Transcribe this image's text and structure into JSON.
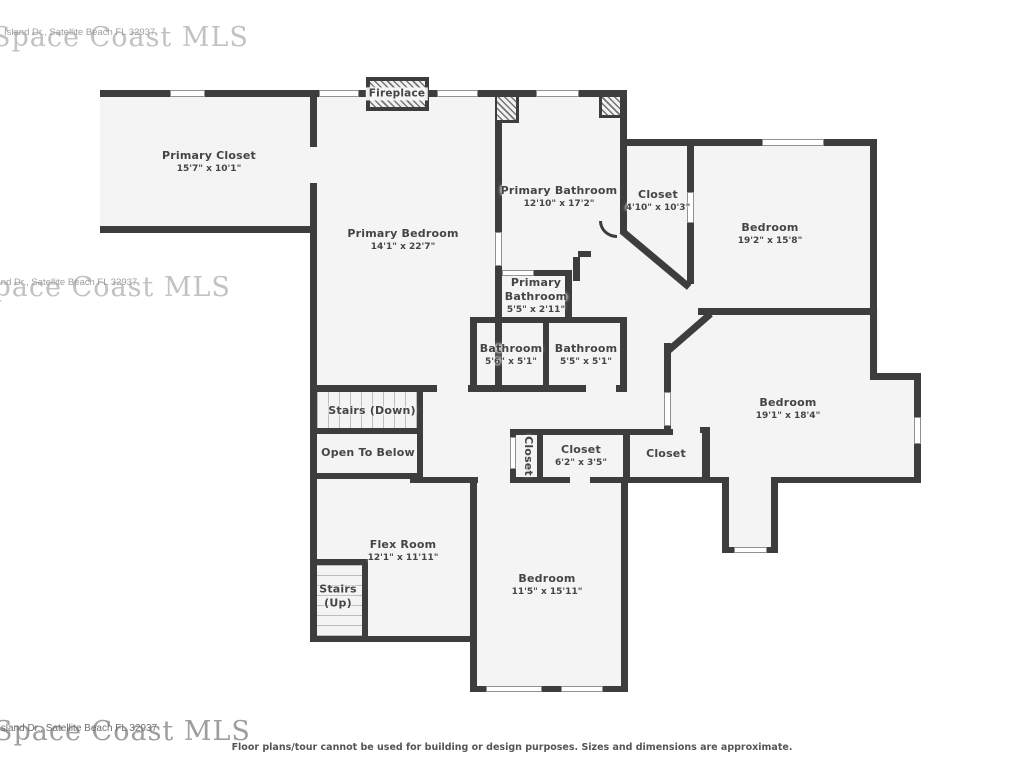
{
  "disclaimer": "Floor plans/tour cannot be used for building or design purposes. Sizes and dimensions are approximate.",
  "watermarks": [
    {
      "big": "Space Coast MLS",
      "small": "Island Dr., Satellite Beach FL 32937"
    },
    {
      "big": "Space Coast MLS",
      "small": "Island Dr., Satellite Beach FL 32937"
    },
    {
      "big": "Space Coast MLS",
      "small": "Island Dr., Satellite Beach FL 32937"
    }
  ],
  "colors": {
    "wall": "#3d3d3d",
    "floor": "#f4f4f4",
    "window_line": "#919191",
    "label": "#454545",
    "watermark": "#c2c2c2"
  },
  "rooms": [
    {
      "id": "primary-closet",
      "name": "Primary Closet",
      "dims": "15'7\" x 10'1\"",
      "cx": 209,
      "cy": 162
    },
    {
      "id": "primary-bedroom",
      "name": "Primary Bedroom",
      "dims": "14'1\" x 22'7\"",
      "cx": 403,
      "cy": 240
    },
    {
      "id": "primary-bathroom",
      "name": "Primary Bathroom",
      "dims": "12'10\" x 17'2\"",
      "cx": 559,
      "cy": 197
    },
    {
      "id": "closet-top",
      "name": "Closet",
      "dims": "4'10\" x 10'3\"",
      "cx": 658,
      "cy": 201
    },
    {
      "id": "bedroom-top-right",
      "name": "Bedroom",
      "dims": "19'2\" x 15'8\"",
      "cx": 770,
      "cy": 234
    },
    {
      "id": "primary-bathroom-small",
      "name": "Primary Bathroom",
      "dims": "5'5\" x 2'11\"",
      "cx": 536,
      "cy": 296,
      "w": 66
    },
    {
      "id": "bathroom-left",
      "name": "Bathroom",
      "dims": "5'6\" x 5'1\"",
      "cx": 511,
      "cy": 355
    },
    {
      "id": "bathroom-right",
      "name": "Bathroom",
      "dims": "5'5\" x 5'1\"",
      "cx": 586,
      "cy": 355
    },
    {
      "id": "bedroom-middle",
      "name": "Bedroom",
      "dims": "19'1\" x 18'4\"",
      "cx": 788,
      "cy": 409
    },
    {
      "id": "stairs-down",
      "name": "Stairs (Down)",
      "dims": "",
      "cx": 372,
      "cy": 411
    },
    {
      "id": "open-to-below",
      "name": "Open To Below",
      "dims": "",
      "cx": 368,
      "cy": 453
    },
    {
      "id": "closet-narrow",
      "name": "Closet",
      "dims": "",
      "cx": 528,
      "cy": 456,
      "rot": 90
    },
    {
      "id": "closet-62",
      "name": "Closet",
      "dims": "6'2\" x 3'5\"",
      "cx": 581,
      "cy": 456
    },
    {
      "id": "closet-right",
      "name": "Closet",
      "dims": "",
      "cx": 666,
      "cy": 454
    },
    {
      "id": "flex-room",
      "name": "Flex Room",
      "dims": "12'1\" x 11'11\"",
      "cx": 403,
      "cy": 551
    },
    {
      "id": "stairs-up",
      "name": "Stairs (Up)",
      "dims": "",
      "cx": 338,
      "cy": 596,
      "w": 46
    },
    {
      "id": "bedroom-bottom",
      "name": "Bedroom",
      "dims": "11'5\" x 15'11\"",
      "cx": 547,
      "cy": 585
    },
    {
      "id": "fireplace",
      "name": "Fireplace",
      "dims": "",
      "cx": 397,
      "cy": 94,
      "fp": true
    }
  ],
  "geometry": {
    "fills": [
      [
        100,
        90,
        217,
        143
      ],
      [
        310,
        90,
        192,
        302
      ],
      [
        495,
        90,
        132,
        227
      ],
      [
        470,
        317,
        157,
        75
      ],
      [
        620,
        139,
        74,
        150
      ],
      [
        690,
        139,
        187,
        176
      ],
      [
        627,
        227,
        73,
        206
      ],
      [
        417,
        385,
        254,
        98
      ],
      [
        671,
        308,
        207,
        175
      ],
      [
        878,
        373,
        43,
        110
      ],
      [
        722,
        483,
        56,
        70
      ],
      [
        510,
        429,
        200,
        54
      ],
      [
        313,
        385,
        110,
        94
      ],
      [
        313,
        479,
        157,
        163
      ],
      [
        470,
        477,
        158,
        215
      ]
    ],
    "stairs": [
      {
        "id": "down",
        "dir": "v",
        "r": [
          317,
          392,
          100,
          36
        ]
      },
      {
        "id": "up",
        "dir": "h",
        "r": [
          316,
          565,
          46,
          71
        ]
      }
    ],
    "walls": [
      [
        100,
        90,
        527,
        7
      ],
      [
        100,
        226,
        217,
        7
      ],
      [
        620,
        139,
        257,
        7
      ],
      [
        698,
        308,
        179,
        7
      ],
      [
        310,
        385,
        127,
        7
      ],
      [
        468,
        385,
        118,
        7
      ],
      [
        616,
        385,
        11,
        7
      ],
      [
        313,
        428,
        110,
        6
      ],
      [
        313,
        473,
        110,
        6
      ],
      [
        510,
        429,
        163,
        6
      ],
      [
        700,
        427,
        10,
        6
      ],
      [
        410,
        477,
        68,
        6
      ],
      [
        510,
        477,
        60,
        6
      ],
      [
        590,
        477,
        120,
        6
      ],
      [
        313,
        636,
        157,
        6
      ],
      [
        470,
        686,
        158,
        6
      ],
      [
        313,
        559,
        55,
        6
      ],
      [
        495,
        270,
        77,
        6
      ],
      [
        470,
        317,
        157,
        6
      ],
      [
        870,
        373,
        51,
        7
      ],
      [
        778,
        477,
        143,
        6
      ],
      [
        722,
        547,
        56,
        6
      ],
      [
        702,
        477,
        27,
        6
      ],
      [
        578,
        251,
        13,
        6
      ],
      [
        310,
        90,
        7,
        57
      ],
      [
        310,
        183,
        7,
        459
      ],
      [
        495,
        97,
        7,
        136
      ],
      [
        495,
        265,
        7,
        127
      ],
      [
        620,
        90,
        7,
        143
      ],
      [
        687,
        146,
        7,
        47
      ],
      [
        687,
        222,
        7,
        62
      ],
      [
        870,
        139,
        7,
        176
      ],
      [
        870,
        312,
        7,
        68
      ],
      [
        914,
        380,
        7,
        38
      ],
      [
        914,
        443,
        7,
        40
      ],
      [
        664,
        343,
        7,
        50
      ],
      [
        664,
        425,
        7,
        8
      ],
      [
        722,
        477,
        7,
        76
      ],
      [
        771,
        477,
        7,
        76
      ],
      [
        510,
        429,
        6,
        9
      ],
      [
        510,
        468,
        6,
        15
      ],
      [
        537,
        435,
        6,
        48
      ],
      [
        623,
        429,
        7,
        54
      ],
      [
        702,
        427,
        8,
        56
      ],
      [
        470,
        477,
        7,
        215
      ],
      [
        621,
        477,
        7,
        215
      ],
      [
        543,
        323,
        6,
        62
      ],
      [
        470,
        317,
        7,
        75
      ],
      [
        565,
        272,
        7,
        45
      ],
      [
        573,
        257,
        7,
        24
      ],
      [
        417,
        392,
        6,
        87
      ],
      [
        362,
        559,
        6,
        83
      ],
      [
        620,
        317,
        7,
        75
      ]
    ],
    "diagonals": [
      {
        "r": [
          624,
          228,
          88,
          7
        ],
        "a": 40
      },
      {
        "r": [
          666,
          348,
          56,
          7
        ],
        "a": -41
      }
    ],
    "windows": [
      [
        170,
        90,
        35,
        7
      ],
      [
        319,
        90,
        40,
        7
      ],
      [
        437,
        90,
        41,
        7
      ],
      [
        536,
        90,
        43,
        7
      ],
      [
        762,
        139,
        62,
        7
      ],
      [
        687,
        192,
        7,
        31
      ],
      [
        495,
        232,
        7,
        34
      ],
      [
        502,
        270,
        32,
        6
      ],
      [
        664,
        392,
        7,
        34
      ],
      [
        914,
        417,
        7,
        27
      ],
      [
        734,
        547,
        33,
        6
      ],
      [
        486,
        686,
        56,
        6
      ],
      [
        561,
        686,
        42,
        6
      ],
      [
        510,
        437,
        6,
        32
      ]
    ],
    "hatches": [
      {
        "id": "fireplace-box",
        "r": [
          366,
          77,
          63,
          34
        ],
        "fp": true
      },
      {
        "id": "hatch-box-left",
        "r": [
          497,
          97,
          22,
          26
        ],
        "b": "rb"
      },
      {
        "id": "hatch-box-right",
        "r": [
          599,
          97,
          21,
          21
        ],
        "b": "lb"
      }
    ],
    "arcs": [
      {
        "r": [
          599,
          221,
          18,
          17
        ]
      }
    ]
  }
}
